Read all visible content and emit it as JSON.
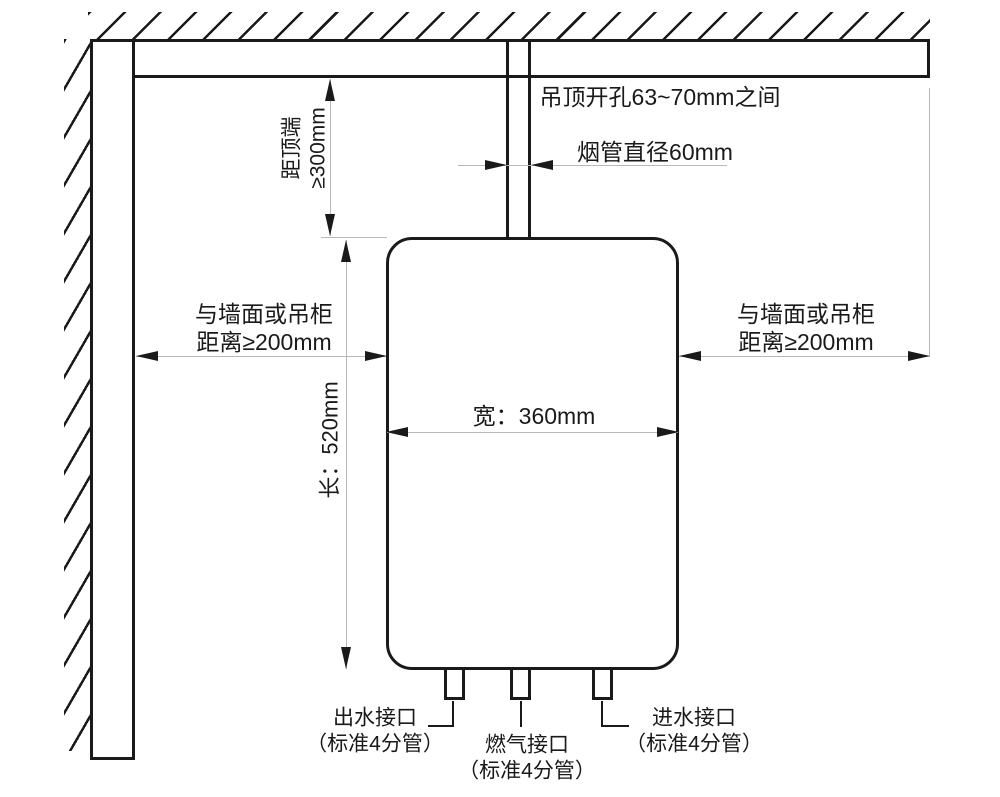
{
  "diagram": {
    "title_hint": "燃气热水器安装尺寸示意图",
    "ceiling": {
      "opening_label": "吊顶开孔63~70mm之间"
    },
    "flue": {
      "diameter_label": "烟管直径60mm"
    },
    "clearances": {
      "top": {
        "line1": "距顶端",
        "line2": "≥300mm"
      },
      "left": {
        "line1": "与墙面或吊柜",
        "line2": "距离≥200mm"
      },
      "right": {
        "line1": "与墙面或吊柜",
        "line2": "距离≥200mm"
      }
    },
    "unit": {
      "width_label": "宽：360mm",
      "height_label": "长：520mm"
    },
    "connections": {
      "outlet": {
        "line1": "出水接口",
        "line2": "（标准4分管）"
      },
      "gas": {
        "line1": "燃气接口",
        "line2": "（标准4分管）"
      },
      "inlet": {
        "line1": "进水接口",
        "line2": "（标准4分管）"
      }
    },
    "colors": {
      "line": "#1a1a1a",
      "dim_line": "#b8b8b8",
      "background": "#ffffff"
    }
  }
}
